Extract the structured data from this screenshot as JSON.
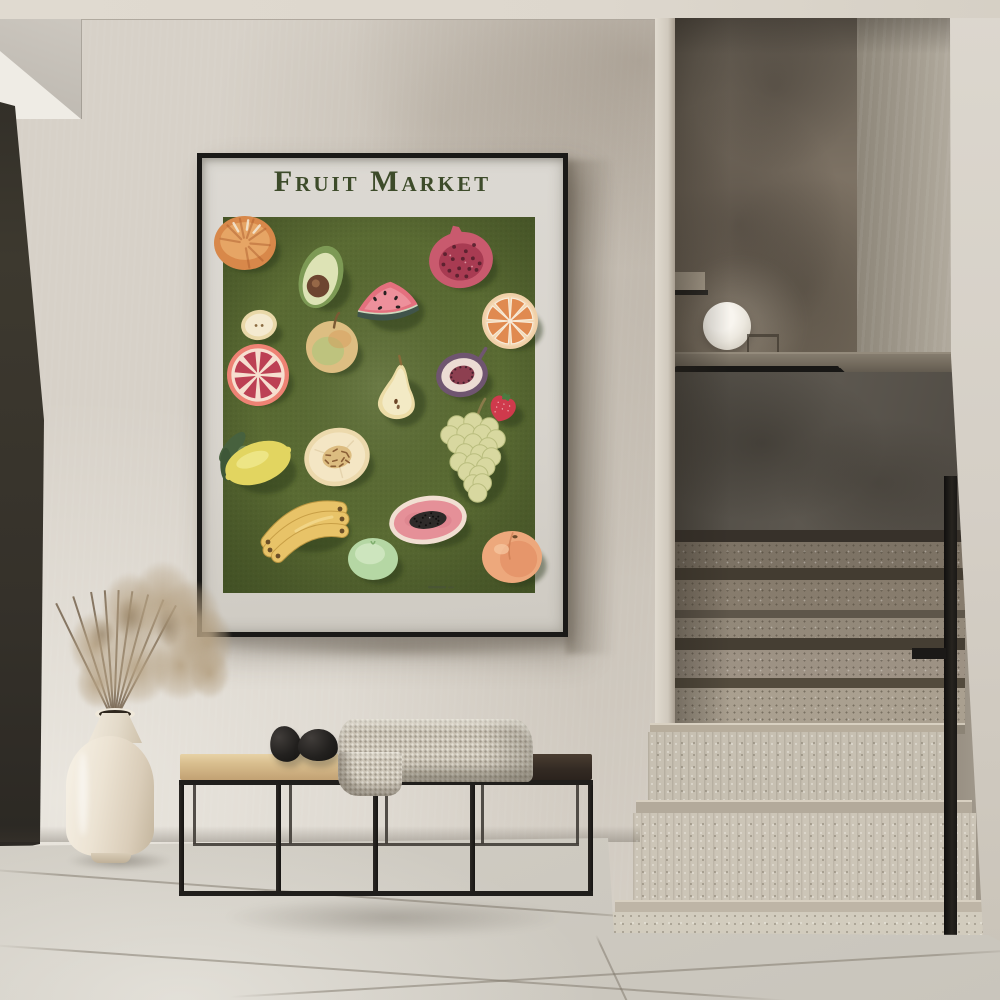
{
  "scene": {
    "type": "interior-photo",
    "palette": {
      "wall": "#d7d1c8",
      "wall_shadow": "#9a8d7e",
      "ceiling": "#ded9cf",
      "floor": "#d5d1c8",
      "door_frame": "#332f28",
      "stair_back_wall": "#6e6458",
      "stair_knee_wall": "#534e47",
      "handrail": "#181715",
      "step_upper": "#8a7f70",
      "step_lower": "#ccc5b7",
      "lamp": "#f3f0e9",
      "bench_frame": "#201e1b",
      "bench_cushion": "#d9bd8e",
      "bench_seat": "#3a3027",
      "blanket": "#cdc6b8",
      "stone": "#1d1b19",
      "vase": "#ece4d4",
      "dried_plant": "#b5a383"
    }
  },
  "poster": {
    "title": "Fruit Market",
    "title_color": "#3d4b2a",
    "frame_color": "#1a1917",
    "paper_color": "#dad6d0",
    "canvas_color": "#5a6b33",
    "fruits": [
      {
        "name": "tangerine",
        "type": "tangerine",
        "cx": 40,
        "cy": 83,
        "rx": 31,
        "ry": 27,
        "rot": 0,
        "colors": [
          "#d8884a",
          "#e8a968",
          "#b06030"
        ]
      },
      {
        "name": "avocado-half",
        "type": "avocado",
        "cx": 116,
        "cy": 117,
        "rx": 25,
        "ry": 32,
        "rot": 18,
        "colors": [
          "#93ab6b",
          "#dde3b5",
          "#6d4530"
        ]
      },
      {
        "name": "pomegranate-half",
        "type": "pomegranate",
        "cx": 256,
        "cy": 100,
        "rx": 32,
        "ry": 28,
        "rot": -8,
        "colors": [
          "#c95a6e",
          "#a83b52",
          "#54202c"
        ]
      },
      {
        "name": "watermelon-slice",
        "type": "watermelon",
        "cx": 184,
        "cy": 143,
        "rx": 31,
        "ry": 25,
        "rot": 0,
        "colors": [
          "#e4707e",
          "#f09ba6",
          "#40544a"
        ]
      },
      {
        "name": "orange-slice",
        "type": "citrus-slice",
        "cx": 305,
        "cy": 161,
        "rx": 28,
        "ry": 26,
        "rot": 0,
        "colors": [
          "#f0d0a8",
          "#e08a50",
          "#f7ead8"
        ]
      },
      {
        "name": "apple-slice",
        "type": "apple-slice",
        "cx": 54,
        "cy": 165,
        "rx": 18,
        "ry": 15,
        "rot": -10,
        "colors": [
          "#e9d8a8",
          "#f4ead0",
          "#8a6a40"
        ]
      },
      {
        "name": "yellow-apple",
        "type": "apple",
        "cx": 127,
        "cy": 187,
        "rx": 26,
        "ry": 25,
        "rot": 0,
        "colors": [
          "#ddbe82",
          "#b8c47e",
          "#7a5a34"
        ]
      },
      {
        "name": "grapefruit-half",
        "type": "grapefruit",
        "cx": 53,
        "cy": 215,
        "rx": 31,
        "ry": 28,
        "rot": 0,
        "colors": [
          "#ee8274",
          "#bc4054",
          "#f6dfd0"
        ]
      },
      {
        "name": "pear-half",
        "type": "pear",
        "cx": 192,
        "cy": 234,
        "rx": 24,
        "ry": 30,
        "rot": 8,
        "colors": [
          "#ecdca6",
          "#f4ecca",
          "#8a6a3a"
        ]
      },
      {
        "name": "fig-half",
        "type": "fig",
        "cx": 257,
        "cy": 215,
        "rx": 26,
        "ry": 22,
        "rot": -12,
        "colors": [
          "#6f5570",
          "#8d3f50",
          "#46202e"
        ]
      },
      {
        "name": "strawberry",
        "type": "strawberry",
        "cx": 298,
        "cy": 247,
        "rx": 15,
        "ry": 14,
        "rot": 18,
        "colors": [
          "#cf3a4c",
          "#4c7a40",
          "#f2c2c2"
        ]
      },
      {
        "name": "lemon",
        "type": "lemon",
        "cx": 53,
        "cy": 303,
        "rx": 34,
        "ry": 28,
        "rot": -20,
        "colors": [
          "#e2d560",
          "#47613e",
          "#6b8456"
        ]
      },
      {
        "name": "melon-half",
        "type": "melon",
        "cx": 132,
        "cy": 297,
        "rx": 33,
        "ry": 29,
        "rot": -15,
        "colors": [
          "#ecd9ac",
          "#f4e6c4",
          "#8a5f36"
        ]
      },
      {
        "name": "green-grapes",
        "type": "grapes",
        "cx": 268,
        "cy": 300,
        "rx": 30,
        "ry": 47,
        "rot": 0,
        "colors": [
          "#d8d8a0",
          "#b9bd7e",
          "#8a7a4a"
        ]
      },
      {
        "name": "bananas",
        "type": "bananas",
        "cx": 101,
        "cy": 362,
        "rx": 41,
        "ry": 27,
        "rot": 0,
        "colors": [
          "#e8c368",
          "#c49b43",
          "#6b4f28"
        ]
      },
      {
        "name": "papaya-half",
        "type": "papaya",
        "cx": 223,
        "cy": 360,
        "rx": 39,
        "ry": 24,
        "rot": -8,
        "colors": [
          "#f1dfd2",
          "#e59098",
          "#2e2a29"
        ]
      },
      {
        "name": "green-apple",
        "type": "green-apple",
        "cx": 168,
        "cy": 399,
        "rx": 25,
        "ry": 21,
        "rot": 0,
        "colors": [
          "#b5d7a4",
          "#d3e8c4",
          "#7fae6e"
        ]
      },
      {
        "name": "peach",
        "type": "peach",
        "cx": 307,
        "cy": 397,
        "rx": 30,
        "ry": 26,
        "rot": 0,
        "colors": [
          "#eda87c",
          "#e18a60",
          "#6b4a2a"
        ]
      }
    ]
  }
}
